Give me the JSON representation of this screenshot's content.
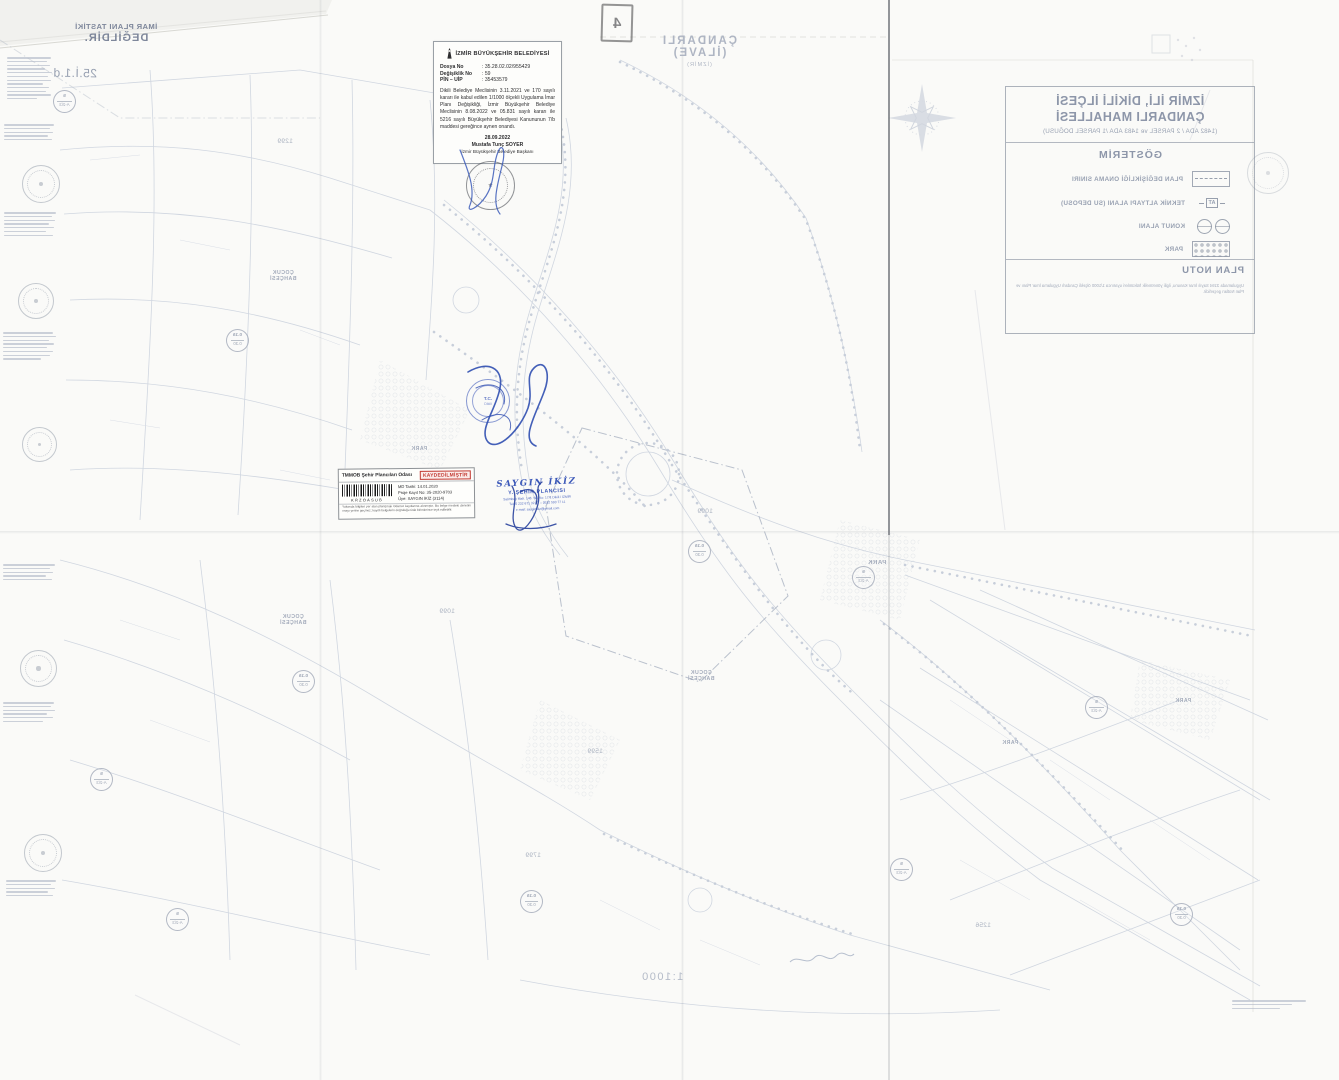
{
  "colors": {
    "registered_red": "#c23a32",
    "stamp_blue": "#3a57b8",
    "seal_blue": "#5f75c4"
  },
  "header_note": {
    "line1": "ÇANDARLI (İLAVE)",
    "line2": "(İZMİR)"
  },
  "corner_symbol": {
    "glyph": "4"
  },
  "disclaimer": {
    "line1": "İMAR PLANI TASTİKİ",
    "line2": "DEĞİLDİR.",
    "sheet_no": "25.İ.1.d"
  },
  "approval": {
    "municipality": "İZMİR BÜYÜKŞEHİR BELEDİYESİ",
    "fields": [
      {
        "label": "Dosya No",
        "value": ": 35.28.02.02/955429"
      },
      {
        "label": "Değişiklik No",
        "value": ": 59"
      },
      {
        "label": "PİN – UİP",
        "value": ": 35453579"
      }
    ],
    "body": "Dikili Belediye Meclisinin 3.11.2021 ve 170 sayılı kararı ile kabul edilen 1/1000 ölçekli Uygulama İmar Planı Değişikliği, İzmir Büyükşehir Belediye Meclisinin 8.08.2022 ve 05.831 sayılı kararı ile 5216 sayılı Büyükşehir Belediyesi Kanununun 7/b maddesi gereğince aynen onandı.",
    "date": "28.09.2022",
    "signatory": "Mustafa Tunç SOYER",
    "signatory_title": "İzmir Büyükşehir Belediye Başkanı"
  },
  "registration": {
    "organization": "TMMOB Şehir Plancıları Odası",
    "status": "KAYDEDİLMİŞTİR",
    "barcode_text": "KRZOASUB",
    "fields": [
      "MD Tarihi: 14.01.2020",
      "Proje Kayıt No: 35-2020-9703",
      "Üye: SAYGIN İKİZ (3114)"
    ],
    "fine_print": "Yukarıda bilgileri yer alan plan/proje Odamız kayıtlarına alınmıştır. Bu belge mesleki denetim onayı yerine geçmez; kayıtlı belgelerin doğruluğu Oda birimlerince teyit edilebilir."
  },
  "planner_stamp": {
    "name": "SAYGIN İKİZ",
    "title": "Y. ŞEHİR PLANCISI",
    "lines": [
      "Salimbey Mah. 148. Sk. No: 17/1 Dikili / İZMİR",
      "Tel: 0 232 671 32 27 – 0532 593 77 11",
      "e-mail: sayginikiz@gmail.com"
    ]
  },
  "seal": {
    "center_top": "T.C.",
    "center_bottom": "Dikili"
  },
  "title_block": {
    "line1": "İZMİR İLİ, DİKİLİ İLÇESİ",
    "line2": "ÇANDARLI MAHALLESİ",
    "line3": "(1482 ADA / 2 PARSEL ve 1483 ADA /1 PARSEL DOĞUSU)",
    "legend_title": "GÖSTERİM",
    "legend": [
      {
        "label": "PLAN DEĞİŞİKLİĞİ ONAMA SINIRI",
        "symbol_text": ""
      },
      {
        "label": "TEKNİK ALTYAPI ALANI (SU DEPOSU)",
        "symbol_text": "AT"
      },
      {
        "label": "KONUT ALANI",
        "symbol_text": ""
      },
      {
        "label": "PARK",
        "symbol_text": ""
      }
    ],
    "note_title": "PLAN NOTU",
    "note": "Uygulamada 3194 Sayılı İmar Kanunu, ilgili yönetmelik hükümleri uyarınca 1/1000 ölçekli Çandarlı Uygulama İmar Planı ve Plan Notları geçerlidir."
  },
  "scale_text": "1:1000",
  "map_labels": [
    {
      "text": "PARK"
    },
    {
      "text": "PARK"
    },
    {
      "text": "PARK"
    },
    {
      "text": "PARK"
    },
    {
      "text": "ÇOCUK BAHÇESİ"
    },
    {
      "text": "ÇOCUK BAHÇESİ"
    },
    {
      "text": "ÇOCUK BAHÇESİ"
    },
    {
      "text": "1299"
    },
    {
      "text": "1099"
    },
    {
      "text": "1599"
    },
    {
      "text": "1799"
    },
    {
      "text": "1256"
    },
    {
      "text": "1099"
    }
  ],
  "zone_values": [
    {
      "top": "5",
      "bottom": "A-2/3"
    },
    {
      "top": "0.15",
      "bottom": "0.30"
    }
  ]
}
